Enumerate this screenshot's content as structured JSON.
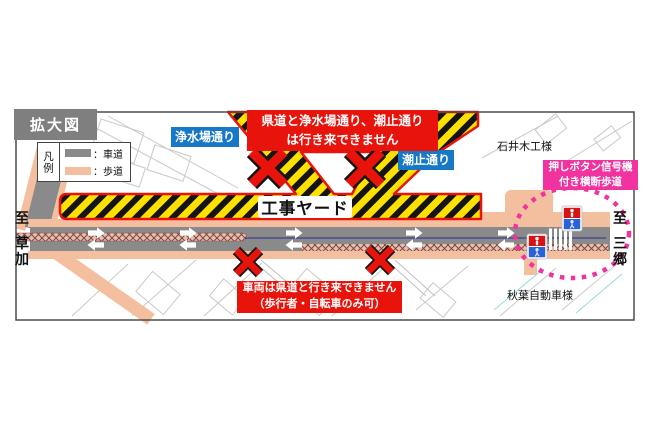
{
  "title_box": "拡大図",
  "legend": {
    "title": "凡例",
    "items": [
      {
        "label": "：車道",
        "color": "#8a8a8a"
      },
      {
        "label": "：歩道",
        "color": "#f4bf9e"
      }
    ]
  },
  "street_labels": {
    "josuijo": "浄水場通り",
    "shiodome": "潮止通り"
  },
  "notices": {
    "top_line1": "県道と浄水場通り、潮止通り",
    "top_line2": "は行き来できません",
    "bottom_line1": "車両は県道と行き来できません",
    "bottom_line2": "（歩行者・自転車のみ可）"
  },
  "yard_label": "工事ヤード",
  "crossing_note": {
    "line1": "押しボタン信号機",
    "line2": "付き横断歩道"
  },
  "landmarks": {
    "ishii": "石井木工様",
    "akiba": "秋葉自動車様"
  },
  "directions": {
    "left_to": "至",
    "left_place": "草加",
    "right_to": "至",
    "right_place": "三郷"
  },
  "colors": {
    "closure_red": "#e8140c",
    "yard_yellow": "#ffe100",
    "roadway_gray": "#8a8a8a",
    "sidewalk_orange": "#f4bf9e",
    "street_label_blue": "#1778c8",
    "crossing_magenta": "#f0339f"
  }
}
